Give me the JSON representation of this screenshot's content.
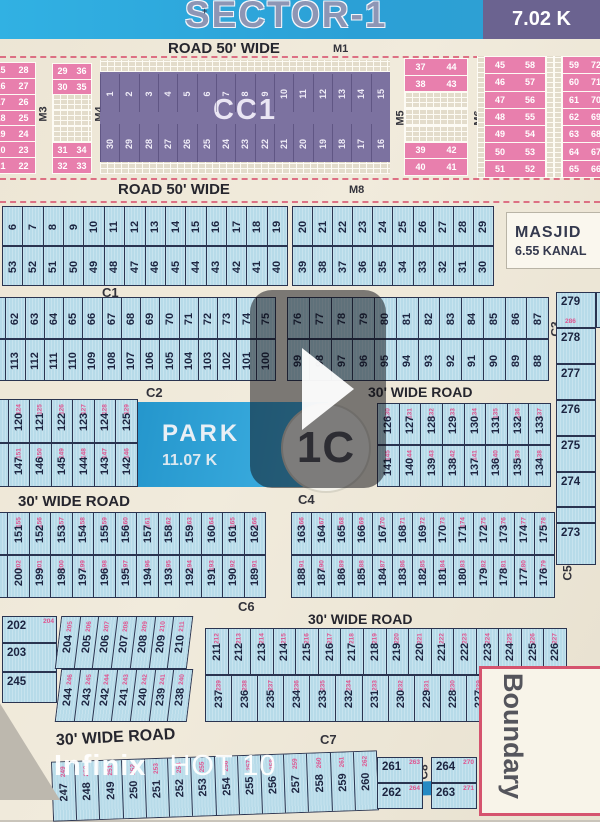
{
  "header": {
    "title": "SECTOR-1",
    "badge": "7.02 K"
  },
  "road_labels": {
    "r1": "ROAD 50' WIDE",
    "r1_m": "M1",
    "r2": "ROAD 50' WIDE",
    "r2_m": "M8",
    "w30_a": "30' WIDE ROAD",
    "w30_b": "30' WIDE ROAD",
    "w30_c": "30' WIDE ROAD",
    "w30_d": "30' WIDE ROAD"
  },
  "markers": {
    "m3": "M3",
    "m4": "M4",
    "m5": "M5",
    "m6": "M6",
    "m7": "M7",
    "c1": "C1",
    "c2": "C2",
    "c3": "C3",
    "c4": "C4",
    "c5": "C5",
    "c6": "C6",
    "c7": "C7",
    "c8": "C8"
  },
  "masjid": {
    "title": "MASJID",
    "area": "6.55 KANAL"
  },
  "park": {
    "title": "PARK",
    "area": "11.07 K"
  },
  "sector_circle": "1C",
  "boundary": "Boundary",
  "photo_watermark": {
    "brand": "Infinix",
    "model": "HOT 10"
  },
  "colors": {
    "header_blue": "#2ba0d6",
    "badge_purple": "#6b6390",
    "plot_pink": "#e87fad",
    "plot_blue": "#b7dbe9",
    "cc1_purple": "#7c72a0",
    "park_blue": "#2b9fd6",
    "dash_red": "#d9536f",
    "num_dark": "#1c2440",
    "num_pink": "#e0538f"
  },
  "top_band": {
    "col1": [
      "15 28",
      "16 27",
      "17 26",
      "18 25",
      "19 24",
      "20 23",
      "21 22"
    ],
    "col2": [
      "29 36",
      "30 35",
      "#",
      "#",
      "#",
      "31 34",
      "32 33"
    ],
    "cc1": {
      "label": "CC1",
      "top": [
        "1",
        "2",
        "3",
        "4",
        "5",
        "6",
        "7",
        "8",
        "9",
        "10",
        "11",
        "12",
        "13",
        "14",
        "15"
      ],
      "bottom": [
        "30",
        "29",
        "28",
        "27",
        "26",
        "25",
        "24",
        "23",
        "22",
        "21",
        "20",
        "19",
        "18",
        "17",
        "16"
      ]
    },
    "col3": [
      "37 44",
      "38 43",
      "#",
      "#",
      "#",
      "39 42",
      "40 41"
    ],
    "col4": [
      "45 58",
      "46 57",
      "47 56",
      "48 55",
      "49 54",
      "50 53",
      "51 52"
    ],
    "col5": [
      "59 72",
      "60 71",
      "61 70",
      "62 69",
      "63 68",
      "64 67",
      "65 66"
    ]
  },
  "blocks": {
    "r1a": {
      "top": [
        "6",
        "7",
        "8",
        "9",
        "10",
        "11",
        "12",
        "13",
        "14",
        "15",
        "16",
        "17",
        "18",
        "19"
      ],
      "bottom": [
        "53",
        "52",
        "51",
        "50",
        "49",
        "48",
        "47",
        "46",
        "45",
        "44",
        "43",
        "42",
        "41",
        "40"
      ]
    },
    "r1b": {
      "top": [
        "20",
        "21",
        "22",
        "23",
        "24",
        "25",
        "26",
        "27",
        "28",
        "29"
      ],
      "bottom": [
        "39",
        "38",
        "37",
        "36",
        "35",
        "34",
        "33",
        "32",
        "31",
        "30"
      ]
    },
    "r2a": {
      "top": [
        "61",
        "62",
        "63",
        "64",
        "65",
        "66",
        "67",
        "68",
        "69",
        "70",
        "71",
        "72",
        "73",
        "74",
        "75"
      ],
      "bottom": [
        "114",
        "113",
        "112",
        "111",
        "110",
        "109",
        "108",
        "107",
        "106",
        "105",
        "104",
        "103",
        "102",
        "101",
        "100"
      ]
    },
    "r2b": {
      "top": [
        "76",
        "77",
        "78",
        "79",
        "80",
        "81",
        "82",
        "83",
        "84",
        "85",
        "86",
        "87"
      ],
      "bottom": [
        "99",
        "98",
        "97",
        "96",
        "95",
        "94",
        "93",
        "92",
        "91",
        "90",
        "89",
        "88"
      ]
    },
    "r3a": {
      "top": [
        "119",
        "120",
        "121",
        "122",
        "123",
        "124",
        "125"
      ],
      "topPink": [
        "123",
        "124",
        "125",
        "126",
        "127",
        "128",
        "129"
      ],
      "bottom": [
        "148",
        "147",
        "146",
        "145",
        "144",
        "143",
        "142"
      ],
      "bottomPink": [
        "152",
        "151",
        "150",
        "149",
        "148",
        "147",
        "146"
      ]
    },
    "r3b": {
      "top": [
        "126",
        "127",
        "128",
        "129",
        "130",
        "131",
        "132",
        "133"
      ],
      "topPink": [
        "130",
        "131",
        "132",
        "133",
        "134",
        "135",
        "136",
        "137"
      ],
      "bottom": [
        "141",
        "140",
        "139",
        "138",
        "137",
        "136",
        "135",
        "134"
      ],
      "bottomPink": [
        "145",
        "144",
        "143",
        "142",
        "141",
        "140",
        "139",
        "138"
      ]
    },
    "r4a": {
      "top": [
        "150",
        "151",
        "152",
        "153",
        "154",
        "155",
        "156",
        "157",
        "158",
        "159",
        "160",
        "161",
        "162"
      ],
      "topPink": [
        "154",
        "155",
        "156",
        "157",
        "158",
        "159",
        "160",
        "161",
        "162",
        "163",
        "164",
        "165",
        "166"
      ],
      "bottom": [
        "201",
        "200",
        "199",
        "198",
        "197",
        "196",
        "195",
        "194",
        "193",
        "192",
        "191",
        "190",
        "189"
      ],
      "bottomPink": [
        "203",
        "202",
        "201",
        "200",
        "199",
        "198",
        "197",
        "196",
        "195",
        "194",
        "193",
        "192",
        "191"
      ]
    },
    "r4b": {
      "top": [
        "163",
        "164",
        "165",
        "166",
        "167",
        "168",
        "169",
        "170",
        "171",
        "172",
        "173",
        "174",
        "175"
      ],
      "topPink": [
        "166",
        "167",
        "168",
        "169",
        "170",
        "171",
        "172",
        "173",
        "174",
        "175",
        "176",
        "177",
        "178"
      ],
      "bottom": [
        "188",
        "187",
        "186",
        "185",
        "184",
        "183",
        "182",
        "181",
        "180",
        "179",
        "178",
        "177",
        "176"
      ],
      "bottomPink": [
        "191",
        "190",
        "189",
        "188",
        "187",
        "186",
        "185",
        "184",
        "183",
        "182",
        "181",
        "180",
        "179"
      ]
    },
    "r5w": {
      "side": [
        [
          "202",
          "204"
        ],
        [
          "203",
          ""
        ],
        [
          "245",
          ""
        ]
      ],
      "top": [
        "204",
        "205",
        "206",
        "207",
        "208",
        "209",
        "210"
      ],
      "topPink": [
        "205",
        "206",
        "207",
        "208",
        "209",
        "210",
        "211"
      ],
      "bottom": [
        "244",
        "243",
        "242",
        "241",
        "240",
        "239",
        "238"
      ],
      "bottomPink": [
        "246",
        "245",
        "244",
        "243",
        "242",
        "241",
        "240"
      ]
    },
    "r5b": {
      "top": [
        "211",
        "212",
        "213",
        "214",
        "215",
        "216",
        "217",
        "218",
        "219",
        "220",
        "221",
        "222",
        "223",
        "224",
        "225",
        "226"
      ],
      "topPink": [
        "212",
        "213",
        "214",
        "215",
        "216",
        "217",
        "218",
        "219",
        "220",
        "221",
        "222",
        "223",
        "224",
        "225",
        "226",
        "227"
      ],
      "bottom": [
        "237",
        "236",
        "235",
        "234",
        "233",
        "232",
        "231",
        "230",
        "229",
        "228",
        "227"
      ],
      "bottomPink": [
        "239",
        "238",
        "237",
        "236",
        "235",
        "234",
        "233",
        "232",
        "231",
        "230",
        "229"
      ]
    }
  },
  "right_column": {
    "cells": [
      [
        "279",
        "286"
      ],
      [
        "278",
        ""
      ],
      [
        "277",
        ""
      ],
      [
        "276",
        ""
      ],
      [
        "275",
        ""
      ],
      [
        "274",
        ""
      ],
      [
        "",
        ""
      ],
      [
        "273",
        ""
      ]
    ],
    "edge": "28"
  },
  "bottom_band": {
    "row": [
      "247",
      "248",
      "249",
      "250",
      "251",
      "252",
      "253",
      "254",
      "255",
      "256",
      "257",
      "258",
      "259",
      "260"
    ],
    "rowPink": [
      "249",
      "250",
      "251",
      "252",
      "253",
      "254",
      "255",
      "256",
      "257",
      "258",
      "259",
      "260",
      "261",
      "262"
    ],
    "h1": [
      [
        "261",
        "263"
      ],
      [
        "262",
        "264"
      ]
    ],
    "h2": [
      [
        "264",
        "270"
      ],
      [
        "263",
        "271"
      ]
    ]
  }
}
